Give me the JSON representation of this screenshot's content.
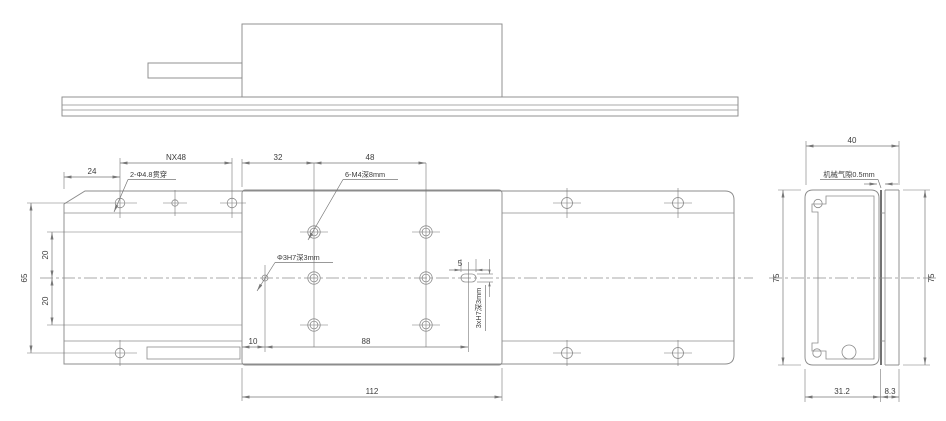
{
  "colors": {
    "line": "#8c8c8c",
    "dim": "#777777",
    "text": "#3c3c3c",
    "background": "#ffffff",
    "air_gap_line": "#5a5a5a"
  },
  "plan": {
    "dims": {
      "edge_to_hole": "24",
      "hole_pitch": "NX48",
      "carriage_to_m4": "32",
      "m4_pitch_x": "48",
      "hole_rows_span": "65",
      "m4_row_gap_upper": "20",
      "m4_row_gap_lower": "20",
      "dowel_offset": "10",
      "dowel_to_slot": "88",
      "carriage_length": "112",
      "slot_length": "5"
    },
    "notes": {
      "through_holes": "2-Φ4.8贯穿",
      "m4_holes": "6-M4深8mm",
      "dowel_hole": "Φ3H7深3mm",
      "slot_spec": "3xH7深3mm"
    }
  },
  "end": {
    "dims": {
      "overall_width": "40",
      "overall_height_left": "75",
      "overall_height_right": "75",
      "body_width": "31.2",
      "plate_width": "8.3"
    },
    "notes": {
      "air_gap": "机械气隙0.5mm"
    }
  }
}
